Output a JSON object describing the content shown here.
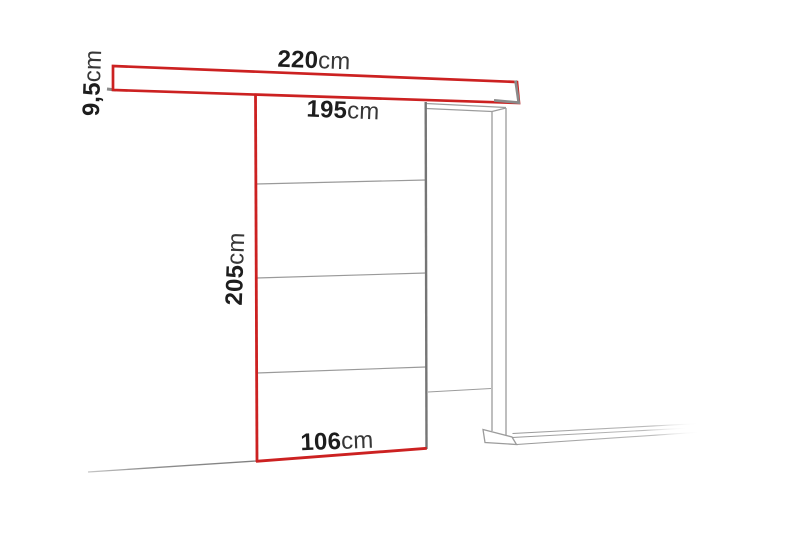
{
  "title": "Sliding door system dimension diagram",
  "colors": {
    "accent_red": "#cc2121",
    "line_gray": "#8f8f8f",
    "frame_gray": "#9c9c9c",
    "door_edge_gray": "#757575",
    "text": "#1d1d1d",
    "text_light": "#373737",
    "background": "#ffffff"
  },
  "dimensions": {
    "track_length": {
      "value": "220",
      "unit": "cm"
    },
    "track_height": {
      "value": "9,5",
      "unit": "cm"
    },
    "top_width": {
      "value": "195",
      "unit": "cm"
    },
    "door_height": {
      "value": "205",
      "unit": "cm"
    },
    "door_width": {
      "value": "106",
      "unit": "cm"
    }
  }
}
